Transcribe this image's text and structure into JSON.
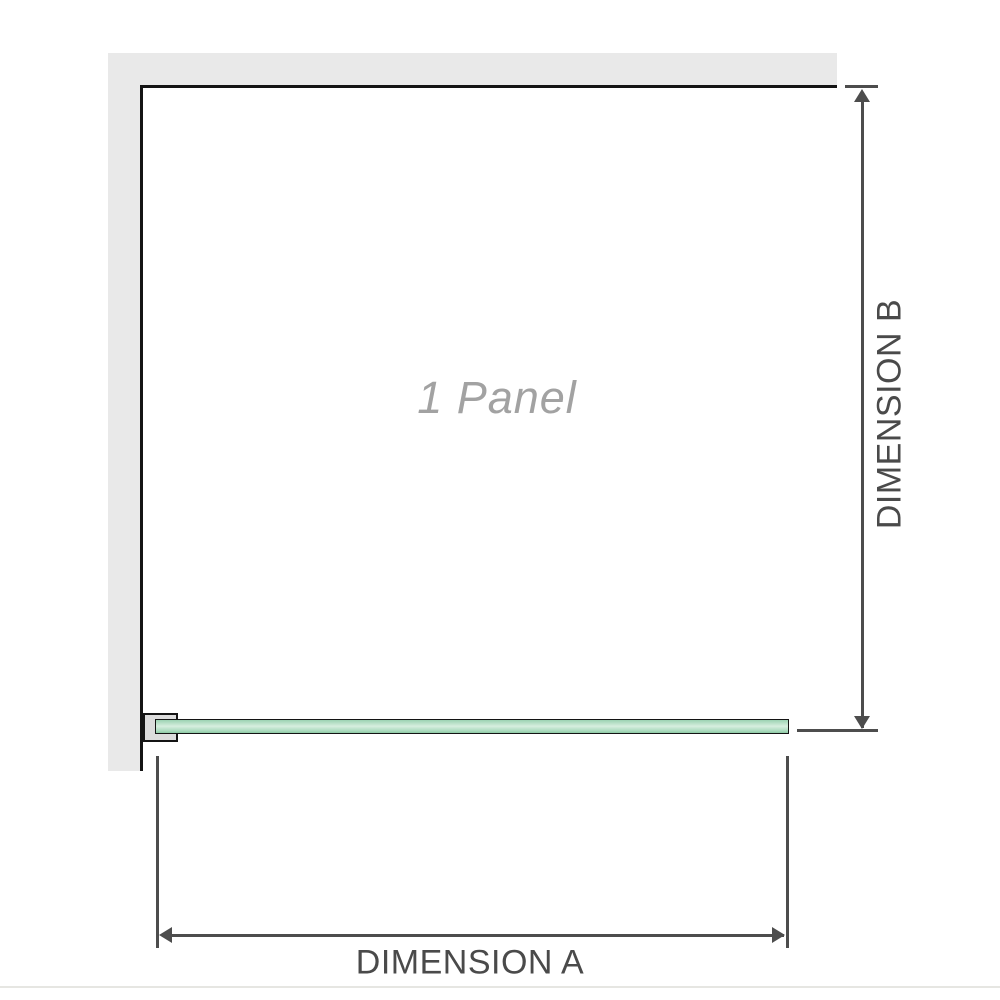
{
  "diagram": {
    "panel_label": "1 Panel",
    "dimension_a": {
      "label": "DIMENSION A"
    },
    "dimension_b": {
      "label": "DIMENSION B"
    }
  },
  "colors": {
    "wall": "#e9e9e9",
    "outline": "#141414",
    "bracket_fill": "#dcdcdc",
    "glass_dark": "#9bd2b2",
    "glass_light": "#d7eedf",
    "glass_mid": "#a9dabc",
    "glass_shadow": "#8cc9a4",
    "dimension": "#4d4d4d",
    "dimension_label": "#4a4a4a",
    "panel_label_gray": "#a2a2a2",
    "page_edge": "#e6e6e2"
  }
}
